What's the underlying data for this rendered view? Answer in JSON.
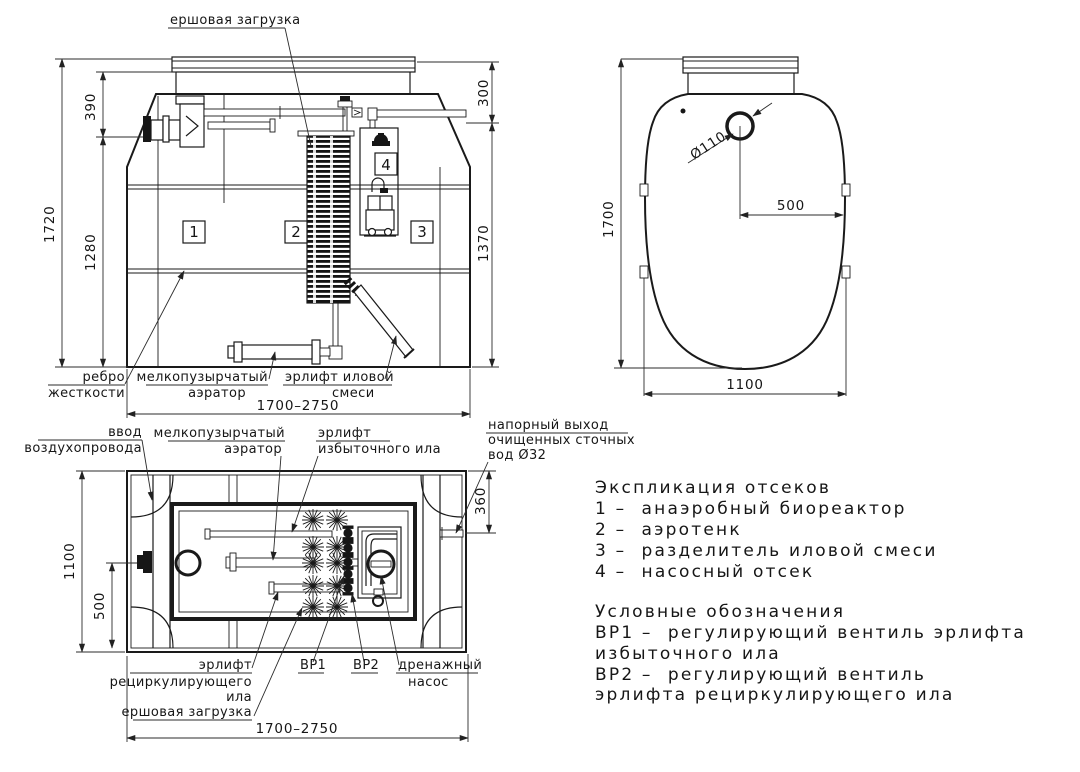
{
  "colors": {
    "ink": "#1a1a1a",
    "paper": "#ffffff"
  },
  "front_view": {
    "labels": {
      "brush": "ершовая загрузка",
      "rib_1": "ребро",
      "rib_2": "жесткости",
      "aerator_1": "мелкопузырчатый",
      "aerator_2": "аэратор",
      "sludge_airlift_1": "эрлифт иловой",
      "sludge_airlift_2": "смеси"
    },
    "compartments": {
      "c1": "1",
      "c2": "2",
      "c3": "3",
      "c4": "4"
    },
    "dims": {
      "total_height": "1720",
      "inlet_drop": "390",
      "inlet_to_bottom": "1280",
      "outlet_drop": "300",
      "outlet_to_bottom": "1370",
      "length_range": "1700–2750"
    }
  },
  "side_view": {
    "dims": {
      "height": "1700",
      "hole_dia": "Ø110",
      "hole_offset": "500",
      "width": "1100"
    }
  },
  "plan_view": {
    "labels": {
      "air_inlet_1": "ввод",
      "air_inlet_2": "воздухопровода",
      "aerator_1": "мелкопузырчатый",
      "aerator_2": "аэратор",
      "excess_airlift_1": "эрлифт",
      "excess_airlift_2": "избыточного ила",
      "outlet_1": "напорный выход",
      "outlet_2": "очищенных сточных",
      "outlet_3": "вод Ø32",
      "recirc_airlift_1": "эрлифт",
      "recirc_airlift_2": "рециркулирующего",
      "recirc_airlift_3": "ила",
      "brush": "ершовая загрузка",
      "valve1": "ВР1",
      "valve2": "ВР2",
      "drain_pump_1": "дренажный",
      "drain_pump_2": "насос"
    },
    "dims": {
      "width": "1100",
      "stub_offset": "500",
      "outlet_offset": "360",
      "length_range": "1700–2750"
    }
  },
  "legend": {
    "sections_title": "Экспликация отсеков",
    "sections": [
      "1 –  анаэробный биореактор",
      "2 –  аэротенк",
      "3 –  разделитель иловой смеси",
      "4 –  насосный отсек"
    ],
    "symbols_title": "Условные обозначения",
    "symbols": [
      "ВР1 –  регулирующий вентиль эрлифта",
      "избыточного ила",
      "ВР2 –  регулирующий вентиль",
      "эрлифта рециркулирующего ила"
    ]
  }
}
